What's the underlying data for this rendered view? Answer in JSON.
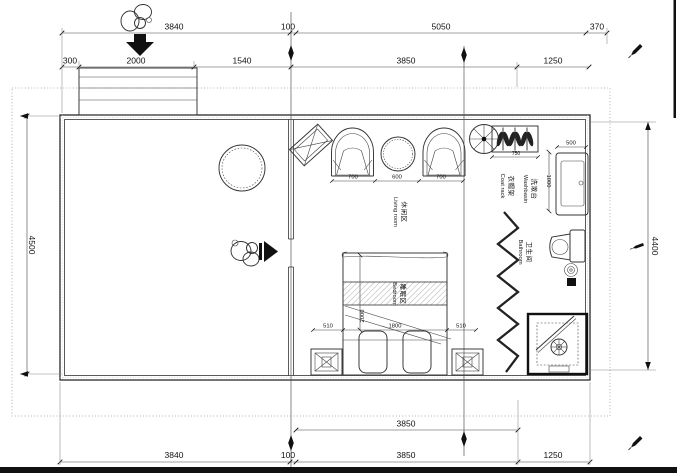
{
  "drawing_title": "apartment floor plan",
  "colors": {
    "line": "#222222",
    "dashed_boundary": "#999999",
    "page_edge": "#111111"
  },
  "icons": {
    "entry_person": "person-top-view-icon",
    "entry_arrow": "arrow-down-icon",
    "door_person": "person-top-view-icon",
    "door_arrow": "arrow-right-icon",
    "fan": "ceiling-fan-icon",
    "grid_marker": "grid-diamond-marker",
    "pen_marks": "pen-marker-icon"
  },
  "labels": {
    "living": {
      "zh": "休闲区",
      "en": "Living room"
    },
    "bedroom": {
      "zh": "睡眠区",
      "en": "Bedroom"
    },
    "bathroom": {
      "zh": "卫生间",
      "en": "Bathroom"
    },
    "washbasin": {
      "zh": "洗漱台",
      "en": "Washbasin"
    },
    "coat_rack": {
      "zh": "衣帽架",
      "en": "Coat rack"
    }
  },
  "dimensions": {
    "top_row1": [
      "3840",
      "100",
      "5050",
      "370"
    ],
    "top_row2": [
      "300",
      "2000",
      "1540",
      "3850",
      "1250"
    ],
    "left": "4500",
    "right": "4400",
    "bottom_inner": "3850",
    "bottom_row": [
      "3840",
      "100",
      "3850",
      "1250"
    ],
    "living_row": [
      "700",
      "600",
      "700"
    ],
    "coat_rack_width": "750",
    "washbasin": [
      "500",
      "1000"
    ],
    "bed_row": [
      "510",
      "1800",
      "510"
    ],
    "bed_length": "2000"
  }
}
